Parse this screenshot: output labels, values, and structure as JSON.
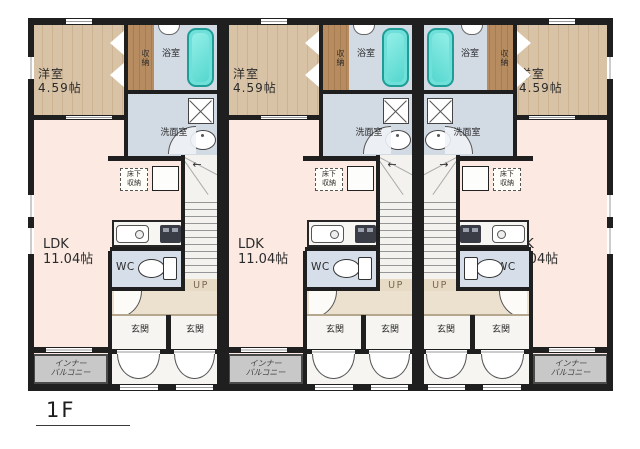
{
  "floor_label": "1F",
  "units": [
    {
      "name": "unit-1",
      "western_room": {
        "label": "洋室",
        "size": "4.59帖"
      },
      "closet_label": "収納",
      "bath_label": "浴室",
      "washroom_label": "洗面室",
      "ldk": {
        "label": "LDK",
        "size": "11.04帖"
      },
      "underfloor_storage_label": "床下\n収納",
      "wc_label": "WC",
      "stairs_label": "UP",
      "stairs_arrow": "←",
      "entrance_left_label": "玄関",
      "entrance_right_label": "玄関",
      "balcony_label": "インナー\nバルコニー"
    },
    {
      "name": "unit-2",
      "western_room": {
        "label": "洋室",
        "size": "4.59帖"
      },
      "closet_label": "収納",
      "bath_label": "浴室",
      "washroom_label": "洗面室",
      "ldk": {
        "label": "LDK",
        "size": "11.04帖"
      },
      "underfloor_storage_label": "床下\n収納",
      "wc_label": "WC",
      "stairs_label": "UP",
      "stairs_arrow": "←",
      "entrance_left_label": "玄関",
      "entrance_right_label": "玄関",
      "balcony_label": "インナー\nバルコニー"
    },
    {
      "name": "unit-3",
      "western_room": {
        "label": "洋室",
        "size": "4.59帖"
      },
      "closet_label": "収納",
      "bath_label": "浴室",
      "washroom_label": "洗面室",
      "ldk": {
        "label": "LDK",
        "size": "11.04帖"
      },
      "underfloor_storage_label": "床下\n収納",
      "wc_label": "WC",
      "stairs_label": "UP",
      "stairs_arrow": "→",
      "entrance_left_label": "玄関",
      "entrance_right_label": "玄関",
      "balcony_label": "インナー\nバルコニー"
    }
  ],
  "colors": {
    "wall": "#1f1f1f",
    "ldk_floor": "#fbe9e2",
    "wood_floor": "#d9c3a7",
    "closet": "#b78c60",
    "bath_floor": "#d2dae4",
    "bathtub": "#6fe0d9",
    "balcony": "#c8c8c8",
    "entrance_floor": "#ece1cf",
    "porch_floor": "#f6f5f2",
    "stairs_tread": "#f4f2ef",
    "landing_floor": "#e8dbc5"
  }
}
